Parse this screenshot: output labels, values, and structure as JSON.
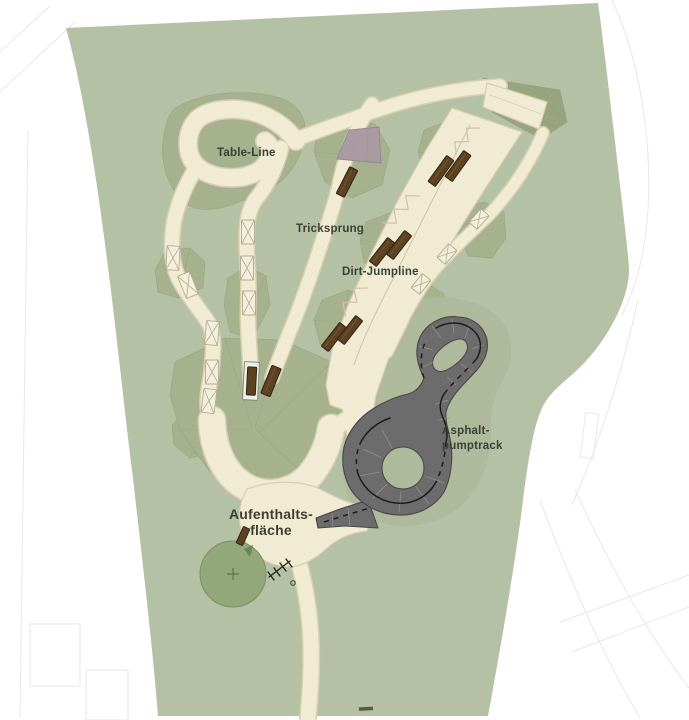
{
  "colors": {
    "outside_white": "#ffffff",
    "faint_line": "#e7e7e7",
    "site_green": "#b5c1a4",
    "mound_green": "#a6b18e",
    "mound_dark": "#97a47e",
    "mound_edge": "#8c9a74",
    "halo_green": "#afb99b",
    "path_cream": "#f2ebd3",
    "path_edge": "#d7cfb2",
    "path_detail": "#cdc6aa",
    "table_cream": "#f4efdd",
    "table_edge": "#b2ab91",
    "wood_brown": "#5d4222",
    "wood_edge": "#2e2517",
    "wood_grain": "#7a5a33",
    "landing_mauve": "#a99ba1",
    "landing_edge": "#918490",
    "pool_white": "#edf0e9",
    "pool_edge": "#848c78",
    "asphalt_gray": "#6c6c6c",
    "asphalt_edge": "#474747",
    "asphalt_seam": "#909090",
    "marking_black": "#1d1d1d",
    "tree_green": "#92a77a",
    "tree_edge": "#7c9062",
    "tree_cross": "#647a50",
    "symbol_dark": "#242424",
    "label_color": "#3c4034"
  },
  "plan": {
    "labels": {
      "table_line": "Table-Line",
      "tricksprung": "Tricksprung",
      "dirt_jumpline": "Dirt-Jumpline",
      "asphalt_pumptrack": [
        "Asphalt-",
        "pumptrack"
      ],
      "aufenthaltsflaeche": [
        "Aufenthalts-",
        "fläche"
      ]
    }
  }
}
